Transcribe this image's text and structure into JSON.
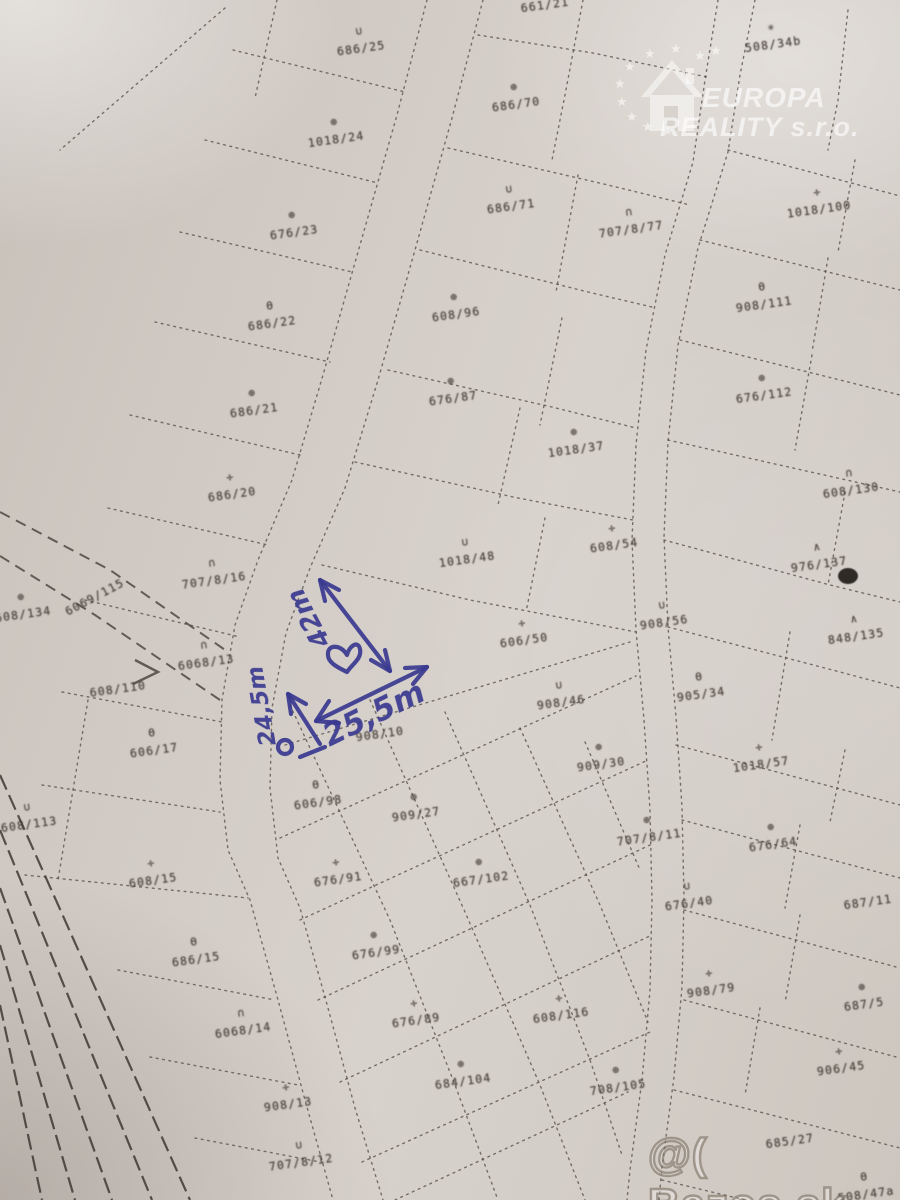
{
  "colors": {
    "paper": "#d2cbc5",
    "map_line": "#4e4741",
    "ink_blue": "#3a3990",
    "watermark": "#ffffff"
  },
  "watermark_top": {
    "icon": "eu-stars-house-icon",
    "line1": "EUROPA",
    "line2": "REALITY s.r.o."
  },
  "watermark_bottom": {
    "text": "@( Bazos.sk"
  },
  "annotation": {
    "shape": "hand-drawn triangle of dimension arrows with heart",
    "sides": {
      "long": "42m",
      "left": "24,5m",
      "bottom": "25,5m"
    }
  },
  "parcels": [
    {
      "id": "686/25",
      "sym": "arc-down",
      "x": 360,
      "y": 46
    },
    {
      "id": "661/21",
      "sym": "none",
      "x": 545,
      "y": 8
    },
    {
      "id": "508/34b",
      "sym": "star",
      "x": 772,
      "y": 42
    },
    {
      "id": "1018/24",
      "sym": "circle-cross",
      "x": 335,
      "y": 137
    },
    {
      "id": "686/70",
      "sym": "circle-cross",
      "x": 515,
      "y": 102
    },
    {
      "id": "676/23",
      "sym": "circle-cross",
      "x": 293,
      "y": 230
    },
    {
      "id": "686/71",
      "sym": "arc-down",
      "x": 510,
      "y": 204
    },
    {
      "id": "707/8/77",
      "sym": "arc-up",
      "x": 630,
      "y": 227
    },
    {
      "id": "1018/100",
      "sym": "cross",
      "x": 818,
      "y": 207
    },
    {
      "id": "686/22",
      "sym": "theta",
      "x": 271,
      "y": 321
    },
    {
      "id": "608/96",
      "sym": "circle-cross",
      "x": 455,
      "y": 312
    },
    {
      "id": "908/111",
      "sym": "theta",
      "x": 763,
      "y": 302
    },
    {
      "id": "686/21",
      "sym": "circle-cross",
      "x": 253,
      "y": 408
    },
    {
      "id": "676/87",
      "sym": "circle-cross",
      "x": 452,
      "y": 396
    },
    {
      "id": "676/112",
      "sym": "circle-cross",
      "x": 763,
      "y": 393
    },
    {
      "id": "686/20",
      "sym": "cross",
      "x": 231,
      "y": 492
    },
    {
      "id": "1018/37",
      "sym": "circle-cross",
      "x": 575,
      "y": 447
    },
    {
      "id": "608/130",
      "sym": "arc-up",
      "x": 850,
      "y": 488
    },
    {
      "id": "707/8/16",
      "sym": "arc-up",
      "x": 213,
      "y": 578
    },
    {
      "id": "1018/48",
      "sym": "arc-down",
      "x": 466,
      "y": 557
    },
    {
      "id": "608/54",
      "sym": "cross",
      "x": 613,
      "y": 543
    },
    {
      "id": "976/137",
      "sym": "caret",
      "x": 818,
      "y": 562
    },
    {
      "id": "608/134",
      "sym": "circle-cross",
      "x": 22,
      "y": 612
    },
    {
      "id": "6069/115",
      "sym": "none",
      "x": 95,
      "y": 600,
      "rot": -28
    },
    {
      "id": "6068/13",
      "sym": "arc-up",
      "x": 205,
      "y": 660
    },
    {
      "id": "608/110",
      "sym": "none",
      "x": 118,
      "y": 692
    },
    {
      "id": "848/135",
      "sym": "caret",
      "x": 855,
      "y": 634
    },
    {
      "id": "908/56",
      "sym": "arc-down",
      "x": 663,
      "y": 620
    },
    {
      "id": "606/50",
      "sym": "cross",
      "x": 523,
      "y": 638
    },
    {
      "id": "606/17",
      "sym": "theta",
      "x": 153,
      "y": 748
    },
    {
      "id": "905/34",
      "sym": "theta",
      "x": 700,
      "y": 692
    },
    {
      "id": "908/46",
      "sym": "arc-down",
      "x": 560,
      "y": 700
    },
    {
      "id": "908/10",
      "sym": "none",
      "x": 380,
      "y": 737
    },
    {
      "id": "1018/57",
      "sym": "cross",
      "x": 760,
      "y": 762
    },
    {
      "id": "909/30",
      "sym": "circle-cross",
      "x": 600,
      "y": 762
    },
    {
      "id": "606/98",
      "sym": "theta",
      "x": 317,
      "y": 800
    },
    {
      "id": "909/27",
      "sym": "circle-cross",
      "x": 415,
      "y": 812
    },
    {
      "id": "608/113",
      "sym": "arc-down",
      "x": 28,
      "y": 822
    },
    {
      "id": "707/8/11",
      "sym": "circle-cross",
      "x": 648,
      "y": 835
    },
    {
      "id": "676/64",
      "sym": "circle-cross",
      "x": 772,
      "y": 842
    },
    {
      "id": "676/91",
      "sym": "cross",
      "x": 337,
      "y": 877
    },
    {
      "id": "667/102",
      "sym": "circle-cross",
      "x": 480,
      "y": 877
    },
    {
      "id": "608/15",
      "sym": "cross",
      "x": 152,
      "y": 878
    },
    {
      "id": "676/40",
      "sym": "arc-down",
      "x": 688,
      "y": 901
    },
    {
      "id": "687/11",
      "sym": "none",
      "x": 868,
      "y": 905
    },
    {
      "id": "686/15",
      "sym": "theta",
      "x": 195,
      "y": 957
    },
    {
      "id": "676/99",
      "sym": "circle-cross",
      "x": 375,
      "y": 950
    },
    {
      "id": "908/79",
      "sym": "cross",
      "x": 710,
      "y": 988
    },
    {
      "id": "687/5",
      "sym": "circle-cross",
      "x": 863,
      "y": 1002
    },
    {
      "id": "6068/14",
      "sym": "arc-up",
      "x": 242,
      "y": 1028
    },
    {
      "id": "676/89",
      "sym": "cross",
      "x": 415,
      "y": 1018
    },
    {
      "id": "608/116",
      "sym": "cross",
      "x": 560,
      "y": 1013
    },
    {
      "id": "906/45",
      "sym": "cross",
      "x": 840,
      "y": 1066
    },
    {
      "id": "684/104",
      "sym": "circle-cross",
      "x": 462,
      "y": 1079
    },
    {
      "id": "908/13",
      "sym": "cross",
      "x": 287,
      "y": 1102
    },
    {
      "id": "708/105",
      "sym": "circle-cross",
      "x": 617,
      "y": 1085
    },
    {
      "id": "707/8/12",
      "sym": "arc-down",
      "x": 300,
      "y": 1160
    },
    {
      "id": "685/27",
      "sym": "none",
      "x": 790,
      "y": 1144
    },
    {
      "id": "508/47a",
      "sym": "theta",
      "x": 865,
      "y": 1192
    }
  ]
}
